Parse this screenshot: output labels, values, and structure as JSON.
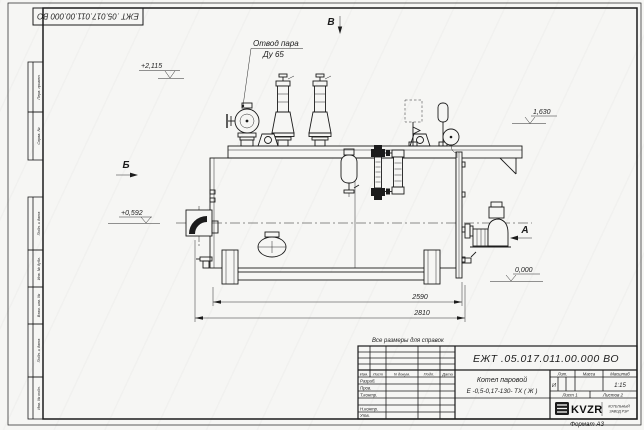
{
  "colors": {
    "line": "#1c1c1c",
    "paper": "#f6f6f4"
  },
  "sheet": {
    "format_note": "Формат А3",
    "note": "Все размеры для справок"
  },
  "corner_stamp": {
    "designation": "ЕЖТ .05.017.011.00.000 ВО"
  },
  "margin_columns": {
    "top": [
      {
        "label": "Перв. примен."
      },
      {
        "label": "Справ. №"
      }
    ],
    "bottom": [
      {
        "label": "Подп. и дата"
      },
      {
        "label": "Инв. № дубл."
      },
      {
        "label": "Взам. инв. №"
      },
      {
        "label": "Подп. и дата"
      },
      {
        "label": "Инв. № подл."
      }
    ]
  },
  "drawing": {
    "view_top": "В",
    "view_left": "Б",
    "view_right": "А",
    "callout_line1": "Отвод пара",
    "callout_line2": "Ду 65",
    "elev_top": "+2,115",
    "elev_right": "1,630",
    "elev_left": "+0,592",
    "elev_zero": "0,000",
    "dim_inner": "2590",
    "dim_outer": "2810"
  },
  "title_block": {
    "designation": "ЕЖТ .05.017.011.00.000 ВО",
    "name_line1": "Котел паровой",
    "name_line2": "Е -0,5-0,17-130- ТХ ( Ж )",
    "col_izm": "Изм.",
    "col_list": "Лист",
    "col_doc": "N докум.",
    "col_podp": "Подп.",
    "col_data": "Дата",
    "row_razrab": "Разраб.",
    "row_prov": "Пров.",
    "row_tkontr": "Т.контр.",
    "row_nkontr": "Н.контр.",
    "row_utv": "Утв.",
    "lit_header": "Лит.",
    "mass_header": "Масса",
    "scale_header": "Масштаб",
    "lit_value": "И",
    "scale_value": "1:15",
    "sheet_current": "Лист 1",
    "sheet_total": "Листов 2",
    "logo_text": "KVZR",
    "company_line1": "КОТЕЛЬНЫЙ",
    "company_line2": "ЗАВОД РЭР"
  }
}
